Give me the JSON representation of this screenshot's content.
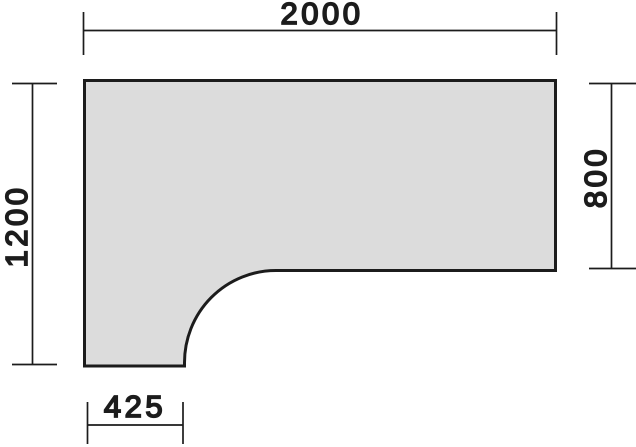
{
  "drawing": {
    "background": "#ffffff",
    "surface": {
      "fill": "#dcdcdc",
      "outline_color": "#1c1c1c"
    },
    "line_color": "#1c1c1c",
    "dimensions": {
      "top_width": {
        "label": "2000"
      },
      "left_height": {
        "label": "1200"
      },
      "right_depth": {
        "label": "800"
      },
      "bottom_notch": {
        "label": "425"
      }
    }
  }
}
